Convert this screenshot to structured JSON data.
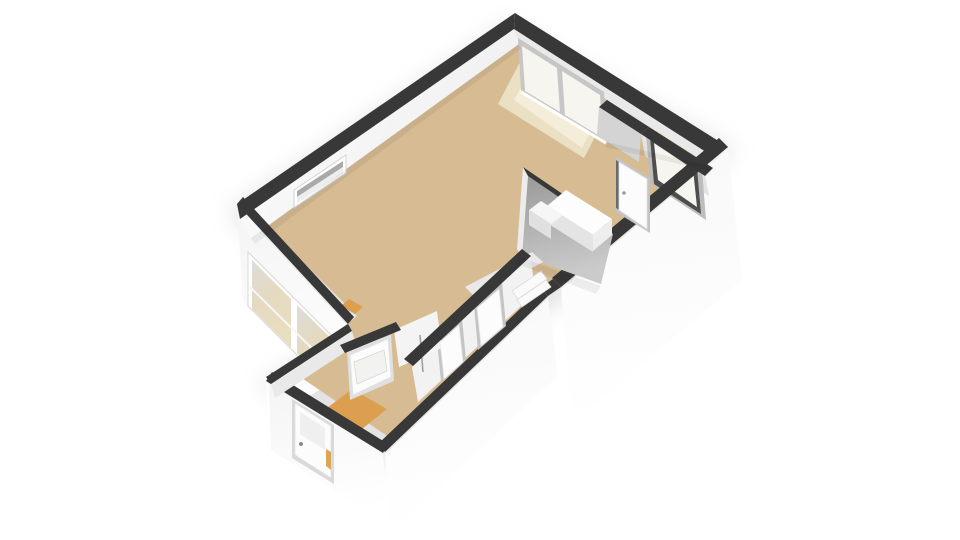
{
  "scene": {
    "label": "3D isometric floor plan render of a small apartment",
    "type": "3d-floorplan",
    "view": "isometric"
  },
  "colors": {
    "background": "#ffffff",
    "shadow": "#cccccc",
    "wall_cap": "#383838",
    "wall_white": "#fbfbfb",
    "wall_shaded": "#f1f1f1",
    "wall_interior_light": "#f7f7f7",
    "wall_interior_mid": "#e9e9e9",
    "wall_gray": "#a0a0a0",
    "wall_gray_light": "#cbcbcb",
    "floor_main": "#d7bc93",
    "floor_highlight": "#efe5cd",
    "floor_entry": "#db9f4f",
    "glass": "#f6f5f0",
    "frame_dark": "#4e4e4e",
    "frame_gray": "#c6c6c6",
    "door_white": "#fcfcfc",
    "accent_orange": "#d79b43"
  },
  "rooms": [
    {
      "name": "living-room",
      "floor": "tan"
    },
    {
      "name": "hallway",
      "floor": "tan"
    },
    {
      "name": "entry-hall",
      "floor": "orange"
    },
    {
      "name": "bathroom",
      "floor": "hidden"
    },
    {
      "name": "toilet",
      "floor": "hidden"
    }
  ],
  "features": {
    "windows": [
      {
        "name": "slot-window-nw",
        "panes": 1
      },
      {
        "name": "picture-window-ne",
        "panes": 2
      },
      {
        "name": "picture-window-sw",
        "panes": 2
      }
    ],
    "doors": [
      {
        "name": "balcony-glass-door"
      },
      {
        "name": "hall-interior-door"
      },
      {
        "name": "bathroom-door"
      },
      {
        "name": "toilet-door"
      },
      {
        "name": "entry-glass-door"
      },
      {
        "name": "front-door"
      }
    ],
    "fixtures": [
      {
        "name": "counter-unit"
      },
      {
        "name": "threshold-steps"
      }
    ]
  }
}
